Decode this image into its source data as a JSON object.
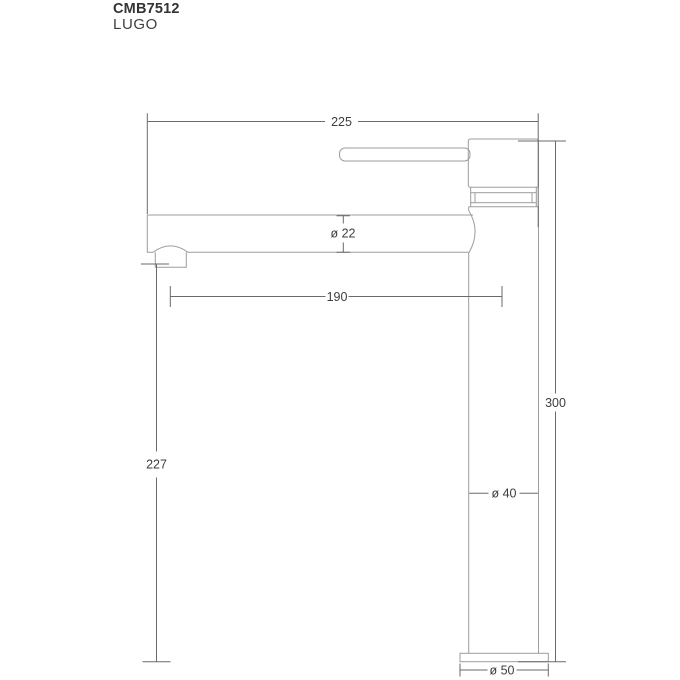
{
  "header": {
    "model": "CMB7512",
    "series": "LUGO"
  },
  "drawing": {
    "type": "faucet-dimension-drawing",
    "labels": {
      "overall_reach": "225",
      "spout_diameter": "ø 22",
      "reach_to_center": "190",
      "height_to_spout": "227",
      "overall_height": "300",
      "body_diameter": "ø 40",
      "base_diameter": "ø 50"
    }
  },
  "colors": {
    "background": "#ffffff",
    "title": "#333333",
    "title2": "#3f3f3f",
    "outline": "#9d9d9d",
    "dimension": "#6a6a6a",
    "text": "#3d3d3d"
  }
}
